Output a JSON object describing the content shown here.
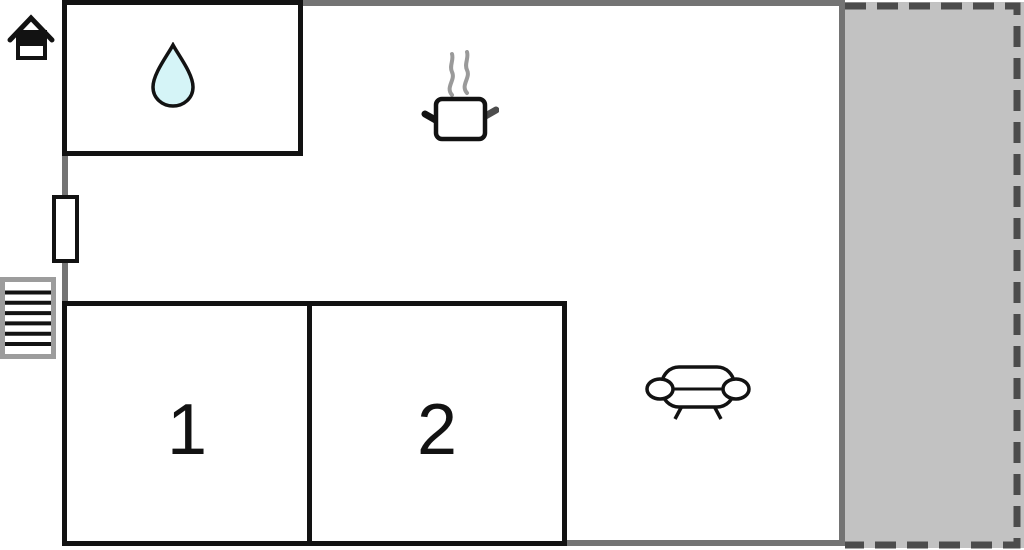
{
  "floorplan": {
    "title": "vacation-home floor plan",
    "rooms": [
      {
        "name": "bathroom",
        "label": "",
        "icon": "water-drop-icon"
      },
      {
        "name": "bedroom-1",
        "label": "1",
        "icon": ""
      },
      {
        "name": "bedroom-2",
        "label": "2",
        "icon": ""
      },
      {
        "name": "kitchen-area",
        "label": "",
        "icon": "cooking-pot-icon"
      },
      {
        "name": "living-area",
        "label": "",
        "icon": "sofa-icon"
      },
      {
        "name": "terrace",
        "label": "",
        "icon": ""
      }
    ],
    "markers": [
      {
        "name": "house-icon"
      },
      {
        "name": "door-icon"
      },
      {
        "name": "stairs-icon"
      }
    ],
    "colors": {
      "background": "#ffffff",
      "wall_gray": "#747474",
      "room_outline": "#121212",
      "terrace_fill": "#c2c2c2",
      "terrace_dashed_border": "#4c4c4c",
      "stairs_frame": "#9c9c9c",
      "steam_gray": "#9a9a9a",
      "water_drop_fill": "#d5f4f7",
      "label_color": "#121212"
    }
  }
}
